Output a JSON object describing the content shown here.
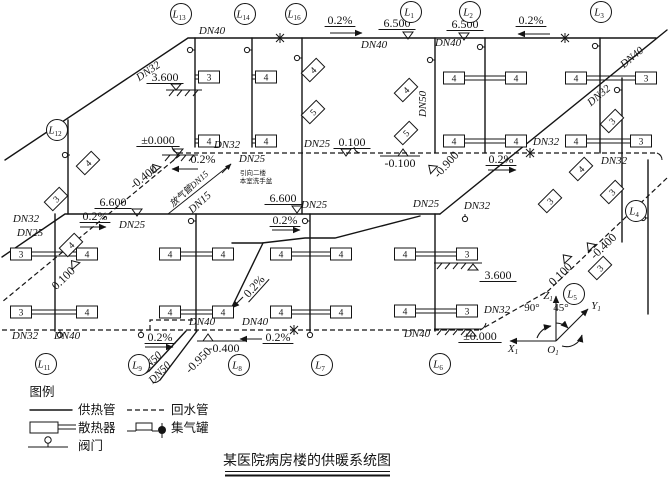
{
  "title": {
    "text": "某医院病房楼的供暖系统图"
  },
  "legend": {
    "heading": "图例",
    "items": {
      "supply": "供热管",
      "return_pipe": "回水管",
      "radiator": "散热器",
      "collector": "集气罐",
      "valve": "阀门"
    }
  },
  "axes": {
    "x": "X",
    "y": "Y",
    "z": "Z",
    "o": "O",
    "sub": "1",
    "angle_xz": "90°",
    "angle_zy": "45°"
  },
  "riser_tags": [
    {
      "t": "L",
      "sub": "13",
      "x": 181,
      "y": 14
    },
    {
      "t": "L",
      "sub": "14",
      "x": 245,
      "y": 14
    },
    {
      "t": "L",
      "sub": "16",
      "x": 296,
      "y": 14
    },
    {
      "t": "L",
      "sub": "1",
      "x": 411,
      "y": 12
    },
    {
      "t": "L",
      "sub": "2",
      "x": 470,
      "y": 12
    },
    {
      "t": "L",
      "sub": "3",
      "x": 601,
      "y": 12
    },
    {
      "t": "L",
      "sub": "12",
      "x": 57,
      "y": 130
    },
    {
      "t": "L",
      "sub": "4",
      "x": 636,
      "y": 211
    },
    {
      "t": "L",
      "sub": "5",
      "x": 574,
      "y": 294
    },
    {
      "t": "L",
      "sub": "11",
      "x": 46,
      "y": 364
    },
    {
      "t": "L",
      "sub": "9",
      "x": 139,
      "y": 365
    },
    {
      "t": "L",
      "sub": "8",
      "x": 239,
      "y": 365
    },
    {
      "t": "L",
      "sub": "7",
      "x": 322,
      "y": 365
    },
    {
      "t": "L",
      "sub": "6",
      "x": 440,
      "y": 364
    }
  ],
  "pipe_labels": [
    {
      "t": "DN32",
      "x": 150,
      "y": 74,
      "r": -34
    },
    {
      "t": "DN40",
      "x": 212,
      "y": 34
    },
    {
      "t": "DN40",
      "x": 374,
      "y": 48
    },
    {
      "t": "DN40",
      "x": 448,
      "y": 46
    },
    {
      "t": "DN50",
      "x": 426,
      "y": 104,
      "r": -90
    },
    {
      "t": "DN40",
      "x": 634,
      "y": 60,
      "r": -40
    },
    {
      "t": "DN32",
      "x": 601,
      "y": 98,
      "r": -40
    },
    {
      "t": "DN32",
      "x": 546,
      "y": 145
    },
    {
      "t": "DN32",
      "x": 614,
      "y": 164
    },
    {
      "t": "DN25",
      "x": 317,
      "y": 147
    },
    {
      "t": "DN32",
      "x": 227,
      "y": 148
    },
    {
      "t": "DN25",
      "x": 252,
      "y": 162
    },
    {
      "t": "DN32",
      "x": 26,
      "y": 222
    },
    {
      "t": "DN25",
      "x": 30,
      "y": 236
    },
    {
      "t": "DN25",
      "x": 132,
      "y": 228
    },
    {
      "t": "DN25",
      "x": 314,
      "y": 208
    },
    {
      "t": "DN25",
      "x": 426,
      "y": 207
    },
    {
      "t": "DN32",
      "x": 477,
      "y": 209
    },
    {
      "t": "DN32",
      "x": 25,
      "y": 339
    },
    {
      "t": "DN40",
      "x": 67,
      "y": 339
    },
    {
      "t": "DN40",
      "x": 202,
      "y": 325
    },
    {
      "t": "DN40",
      "x": 255,
      "y": 325
    },
    {
      "t": "DN40",
      "x": 417,
      "y": 337
    },
    {
      "t": "DN32",
      "x": 497,
      "y": 313
    },
    {
      "t": "DN50",
      "x": 153,
      "y": 365,
      "r": -45
    },
    {
      "t": "DN50",
      "x": 162,
      "y": 375,
      "r": -45
    },
    {
      "t": "放气管DN15",
      "x": 191,
      "y": 191,
      "r": -42,
      "sm": true
    },
    {
      "t": "DN15",
      "x": 202,
      "y": 205,
      "r": -42
    }
  ],
  "elevation_labels": [
    {
      "t": "0.2%",
      "x": 340,
      "y": 24,
      "u": true
    },
    {
      "t": "6.500",
      "x": 397,
      "y": 27,
      "u": true
    },
    {
      "t": "6.500",
      "x": 465,
      "y": 28,
      "u": true
    },
    {
      "t": "0.2%",
      "x": 531,
      "y": 24,
      "u": true
    },
    {
      "t": "3.600",
      "x": 165,
      "y": 81,
      "u": true
    },
    {
      "t": "±0.000",
      "x": 158,
      "y": 144,
      "u": true
    },
    {
      "t": "0.100",
      "x": 352,
      "y": 146,
      "u": true
    },
    {
      "t": "-0.100",
      "x": 400,
      "y": 167
    },
    {
      "t": "-0.900",
      "x": 449,
      "y": 167,
      "r": -48
    },
    {
      "t": "0.2%",
      "x": 501,
      "y": 163,
      "u": true
    },
    {
      "t": "0.2%",
      "x": 203,
      "y": 163
    },
    {
      "t": "6.600",
      "x": 113,
      "y": 206,
      "u": true
    },
    {
      "t": "0.2%",
      "x": 95,
      "y": 220,
      "u": true
    },
    {
      "t": "6.600",
      "x": 283,
      "y": 202,
      "u": true
    },
    {
      "t": "0.2%",
      "x": 285,
      "y": 224,
      "u": true
    },
    {
      "t": "-0.400",
      "x": 146,
      "y": 180,
      "r": -38
    },
    {
      "t": "0.100",
      "x": 66,
      "y": 281,
      "r": -44
    },
    {
      "t": "0.2%",
      "x": 257,
      "y": 289,
      "r": -48,
      "u": true
    },
    {
      "t": "0.2%",
      "x": 160,
      "y": 341,
      "u": true
    },
    {
      "t": "0.2%",
      "x": 278,
      "y": 341,
      "u": true
    },
    {
      "t": "-0.400",
      "x": 224,
      "y": 352
    },
    {
      "t": "-0.950",
      "x": 201,
      "y": 363,
      "r": -45
    },
    {
      "t": "3.600",
      "x": 498,
      "y": 279,
      "u": true
    },
    {
      "t": "±0.000",
      "x": 480,
      "y": 340,
      "u": true
    },
    {
      "t": "0.100",
      "x": 563,
      "y": 277,
      "r": -44
    },
    {
      "t": "-0.400",
      "x": 606,
      "y": 249,
      "r": -44
    }
  ],
  "note_labels": [
    {
      "t": "引向二楼",
      "x": 253,
      "y": 175
    },
    {
      "t": "本室洗手盆",
      "x": 256,
      "y": 183
    }
  ],
  "radiators": [
    {
      "t": "3",
      "x": 209,
      "y": 77
    },
    {
      "t": "4",
      "x": 266,
      "y": 77
    },
    {
      "t": "4",
      "x": 209,
      "y": 141
    },
    {
      "t": "4",
      "x": 266,
      "y": 141
    },
    {
      "t": "4",
      "x": 454,
      "y": 78
    },
    {
      "t": "4",
      "x": 516,
      "y": 78
    },
    {
      "t": "4",
      "x": 454,
      "y": 141
    },
    {
      "t": "4",
      "x": 516,
      "y": 141
    },
    {
      "t": "4",
      "x": 576,
      "y": 78
    },
    {
      "t": "3",
      "x": 646,
      "y": 78
    },
    {
      "t": "4",
      "x": 576,
      "y": 141
    },
    {
      "t": "3",
      "x": 641,
      "y": 141
    },
    {
      "t": "3",
      "x": 21,
      "y": 254
    },
    {
      "t": "4",
      "x": 87,
      "y": 254
    },
    {
      "t": "3",
      "x": 21,
      "y": 312
    },
    {
      "t": "4",
      "x": 87,
      "y": 312
    },
    {
      "t": "4",
      "x": 170,
      "y": 254
    },
    {
      "t": "4",
      "x": 223,
      "y": 254
    },
    {
      "t": "4",
      "x": 170,
      "y": 312
    },
    {
      "t": "4",
      "x": 223,
      "y": 312
    },
    {
      "t": "4",
      "x": 281,
      "y": 254
    },
    {
      "t": "4",
      "x": 341,
      "y": 254
    },
    {
      "t": "4",
      "x": 281,
      "y": 312
    },
    {
      "t": "4",
      "x": 341,
      "y": 312
    },
    {
      "t": "4",
      "x": 405,
      "y": 254
    },
    {
      "t": "3",
      "x": 467,
      "y": 254
    },
    {
      "t": "4",
      "x": 405,
      "y": 311
    },
    {
      "t": "3",
      "x": 467,
      "y": 311
    },
    {
      "t": "4",
      "x": 313,
      "y": 70,
      "r": -45
    },
    {
      "t": "5",
      "x": 313,
      "y": 112,
      "r": -45
    },
    {
      "t": "4",
      "x": 406,
      "y": 90,
      "r": -45
    },
    {
      "t": "5",
      "x": 406,
      "y": 133,
      "r": -45
    },
    {
      "t": "4",
      "x": 88,
      "y": 163,
      "r": -45
    },
    {
      "t": "3",
      "x": 56,
      "y": 199,
      "r": -45
    },
    {
      "t": "4",
      "x": 71,
      "y": 245,
      "r": -45
    },
    {
      "t": "3",
      "x": 612,
      "y": 121,
      "r": -45
    },
    {
      "t": "4",
      "x": 581,
      "y": 169,
      "r": -45
    },
    {
      "t": "3",
      "x": 550,
      "y": 201,
      "r": -45
    },
    {
      "t": "3",
      "x": 612,
      "y": 192,
      "r": -45
    },
    {
      "t": "3",
      "x": 600,
      "y": 268,
      "r": -45
    }
  ],
  "valves": [
    {
      "x": 195,
      "y": 50,
      "o": "v"
    },
    {
      "x": 252,
      "y": 50,
      "o": "v"
    },
    {
      "x": 302,
      "y": 58,
      "o": "v"
    },
    {
      "x": 435,
      "y": 60,
      "o": "v"
    },
    {
      "x": 485,
      "y": 47,
      "o": "v"
    },
    {
      "x": 600,
      "y": 46,
      "o": "v"
    },
    {
      "x": 622,
      "y": 90,
      "o": "v"
    },
    {
      "x": 70,
      "y": 155,
      "o": "v"
    },
    {
      "x": 196,
      "y": 221,
      "o": "v"
    },
    {
      "x": 310,
      "y": 221,
      "o": "v"
    },
    {
      "x": 465,
      "y": 214,
      "o": "h"
    },
    {
      "x": 60,
      "y": 330,
      "o": "h"
    },
    {
      "x": 141,
      "y": 330,
      "o": "h"
    },
    {
      "x": 310,
      "y": 330,
      "o": "h"
    },
    {
      "x": 648,
      "y": 218,
      "o": "v"
    }
  ]
}
